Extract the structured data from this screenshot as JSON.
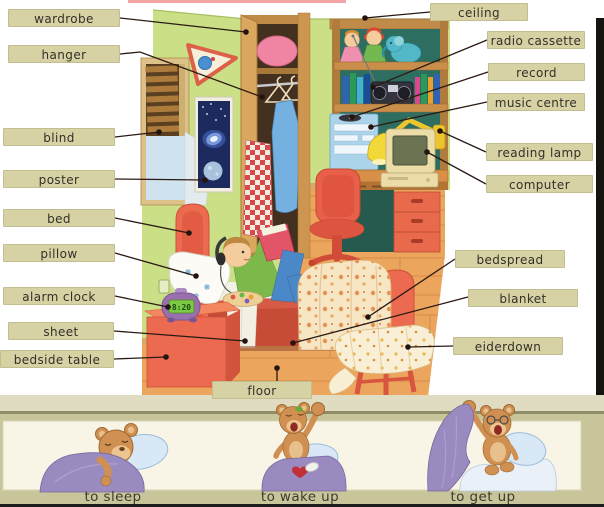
{
  "labels": {
    "left": [
      {
        "id": "wardrobe",
        "text": "wardrobe"
      },
      {
        "id": "hanger",
        "text": "hanger"
      },
      {
        "id": "blind",
        "text": "blind"
      },
      {
        "id": "poster",
        "text": "poster"
      },
      {
        "id": "bed",
        "text": "bed"
      },
      {
        "id": "pillow",
        "text": "pillow"
      },
      {
        "id": "alarm-clock",
        "text": "alarm clock"
      },
      {
        "id": "sheet",
        "text": "sheet"
      },
      {
        "id": "bedside-table",
        "text": "bedside table"
      }
    ],
    "right": [
      {
        "id": "ceiling",
        "text": "ceiling"
      },
      {
        "id": "radio-cassette",
        "text": "radio cassette"
      },
      {
        "id": "record",
        "text": "record"
      },
      {
        "id": "music-centre",
        "text": "music centre"
      },
      {
        "id": "reading-lamp",
        "text": "reading lamp"
      },
      {
        "id": "computer",
        "text": "computer"
      },
      {
        "id": "bedspread",
        "text": "bedspread"
      },
      {
        "id": "blanket",
        "text": "blanket"
      },
      {
        "id": "eiderdown",
        "text": "eiderdown"
      }
    ],
    "bottom": [
      {
        "id": "floor",
        "text": "floor"
      }
    ]
  },
  "scene": {
    "alarm_clock_time": "8:20"
  },
  "actions": [
    {
      "id": "to-sleep",
      "text": "to sleep"
    },
    {
      "id": "to-wake-up",
      "text": "to wake up"
    },
    {
      "id": "to-get-up",
      "text": "to get up"
    }
  ],
  "colors": {
    "label_bg": "#d7d2a4",
    "label_border": "#c3be92",
    "label_text": "#33302a",
    "connector": "#2b1a14",
    "strip_bg": "#c9c59a",
    "strip_top": "#dfdcc1",
    "strip_divider": "#8f8c66",
    "panel_bg": "#f8f5e6",
    "panel_border": "#d9d5b6",
    "caption_text": "#3c3a2e",
    "wall": "#cbdf86",
    "floor": "#eca55c",
    "bed_red": "#ec6a50",
    "teddy_fur": "#cf9052",
    "blanket_purple": "#998ac0",
    "pillow_blue": "#d8e8f6"
  }
}
